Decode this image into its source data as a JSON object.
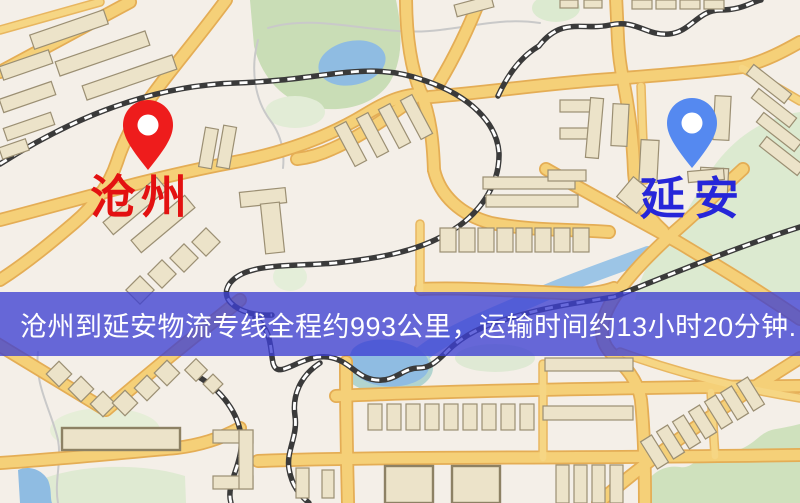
{
  "markers": {
    "origin": {
      "label": "沧州",
      "text_color": "#e31111",
      "pin_color": "#ee1c1c"
    },
    "destination": {
      "label": "延安",
      "text_color": "#2626d9",
      "pin_color": "#5589f0"
    }
  },
  "banner": {
    "text": "沧州到延安物流专线全程约993公里，运输时间约13小时20分钟.",
    "background_color": "rgba(62,64,210,0.78)",
    "text_color": "#ffffff"
  },
  "map_style": {
    "background": "#f4efe8",
    "road_fill": "#f5d078",
    "road_border": "#e4ad55",
    "park_green": "#cfe1bd",
    "water_blue": "#8fbce2",
    "building_fill": "#ece3c9",
    "railway_dark": "#3a3a3a"
  }
}
